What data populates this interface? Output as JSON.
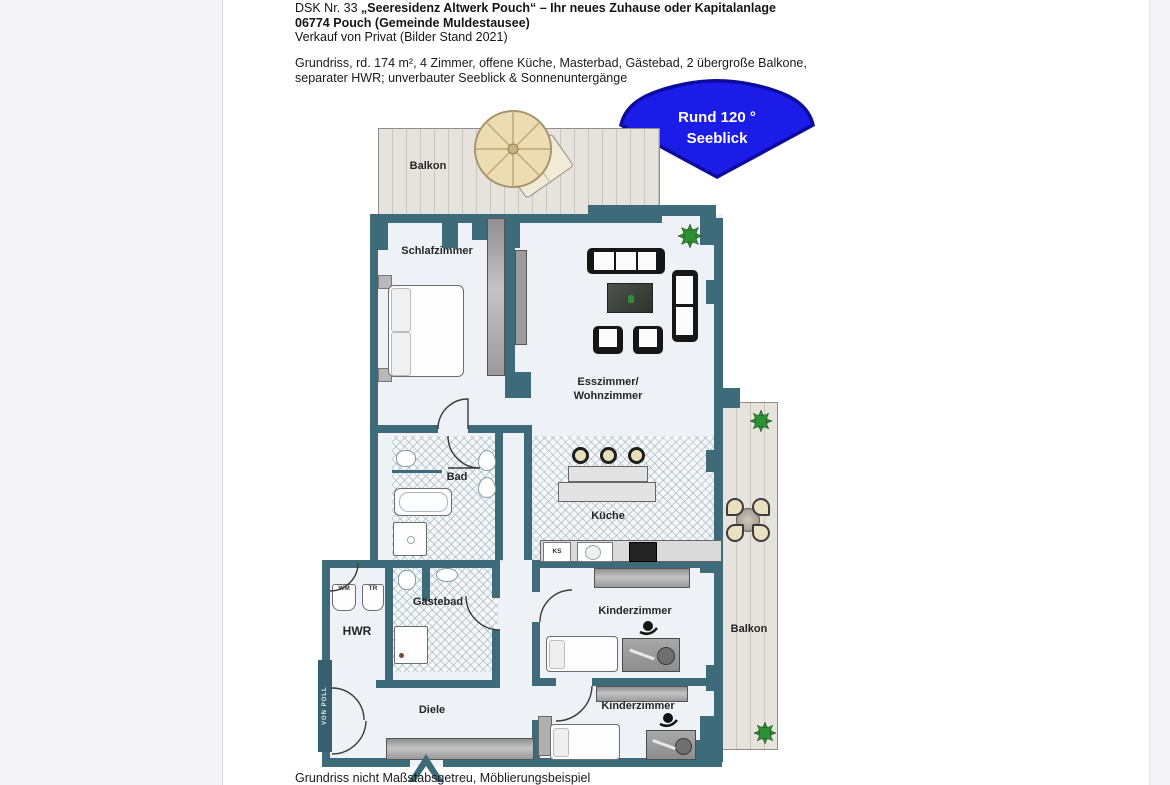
{
  "header": {
    "line1_prefix": "DSK Nr. 33 ",
    "line1_bold": "„Seeresidenz Altwerk Pouch“ – Ihr neues Zuhause oder Kapitalanlage",
    "line2": "06774 Pouch (Gemeinde Muldestausee)",
    "line3": "Verkauf von Privat (Bilder Stand 2021)",
    "desc_line1": "Grundriss, rd. 174 m², 4 Zimmer, offene Küche, Masterbad, Gästebad, 2 übergroße Balkone,",
    "desc_line2": "separater HWR; unverbauter Seeblick & Sonnenuntergänge"
  },
  "badge": {
    "line1": "Rund 120 °",
    "line2": "Seeblick",
    "fill": "#1c1ce8",
    "border": "#0b0b9e"
  },
  "plan": {
    "rooms": {
      "balkon_top": "Balkon",
      "schlafzimmer": "Schlafzimmer",
      "wohnzimmer_line1": "Esszimmer/",
      "wohnzimmer_line2": "Wohnzimmer",
      "bad": "Bad",
      "kueche": "Küche",
      "gaestebad": "Gästebad",
      "hwr": "HWR",
      "kinderzimmer1": "Kinderzimmer",
      "kinderzimmer2": "Kinderzimmer",
      "diele": "Diele",
      "balkon_right": "Balkon"
    },
    "appliances": {
      "wm": "WM",
      "tr": "TR",
      "ks": "KS"
    },
    "watermark": "VON POLL",
    "colors": {
      "wall": "#3e6b7a",
      "floor": "#eef1f5",
      "balcony_wood": "#e5e3dc",
      "badge_blue": "#1c1ce8"
    }
  },
  "caption": "Grundriss nicht Maßstabsgetreu, Möblierungsbeispiel"
}
